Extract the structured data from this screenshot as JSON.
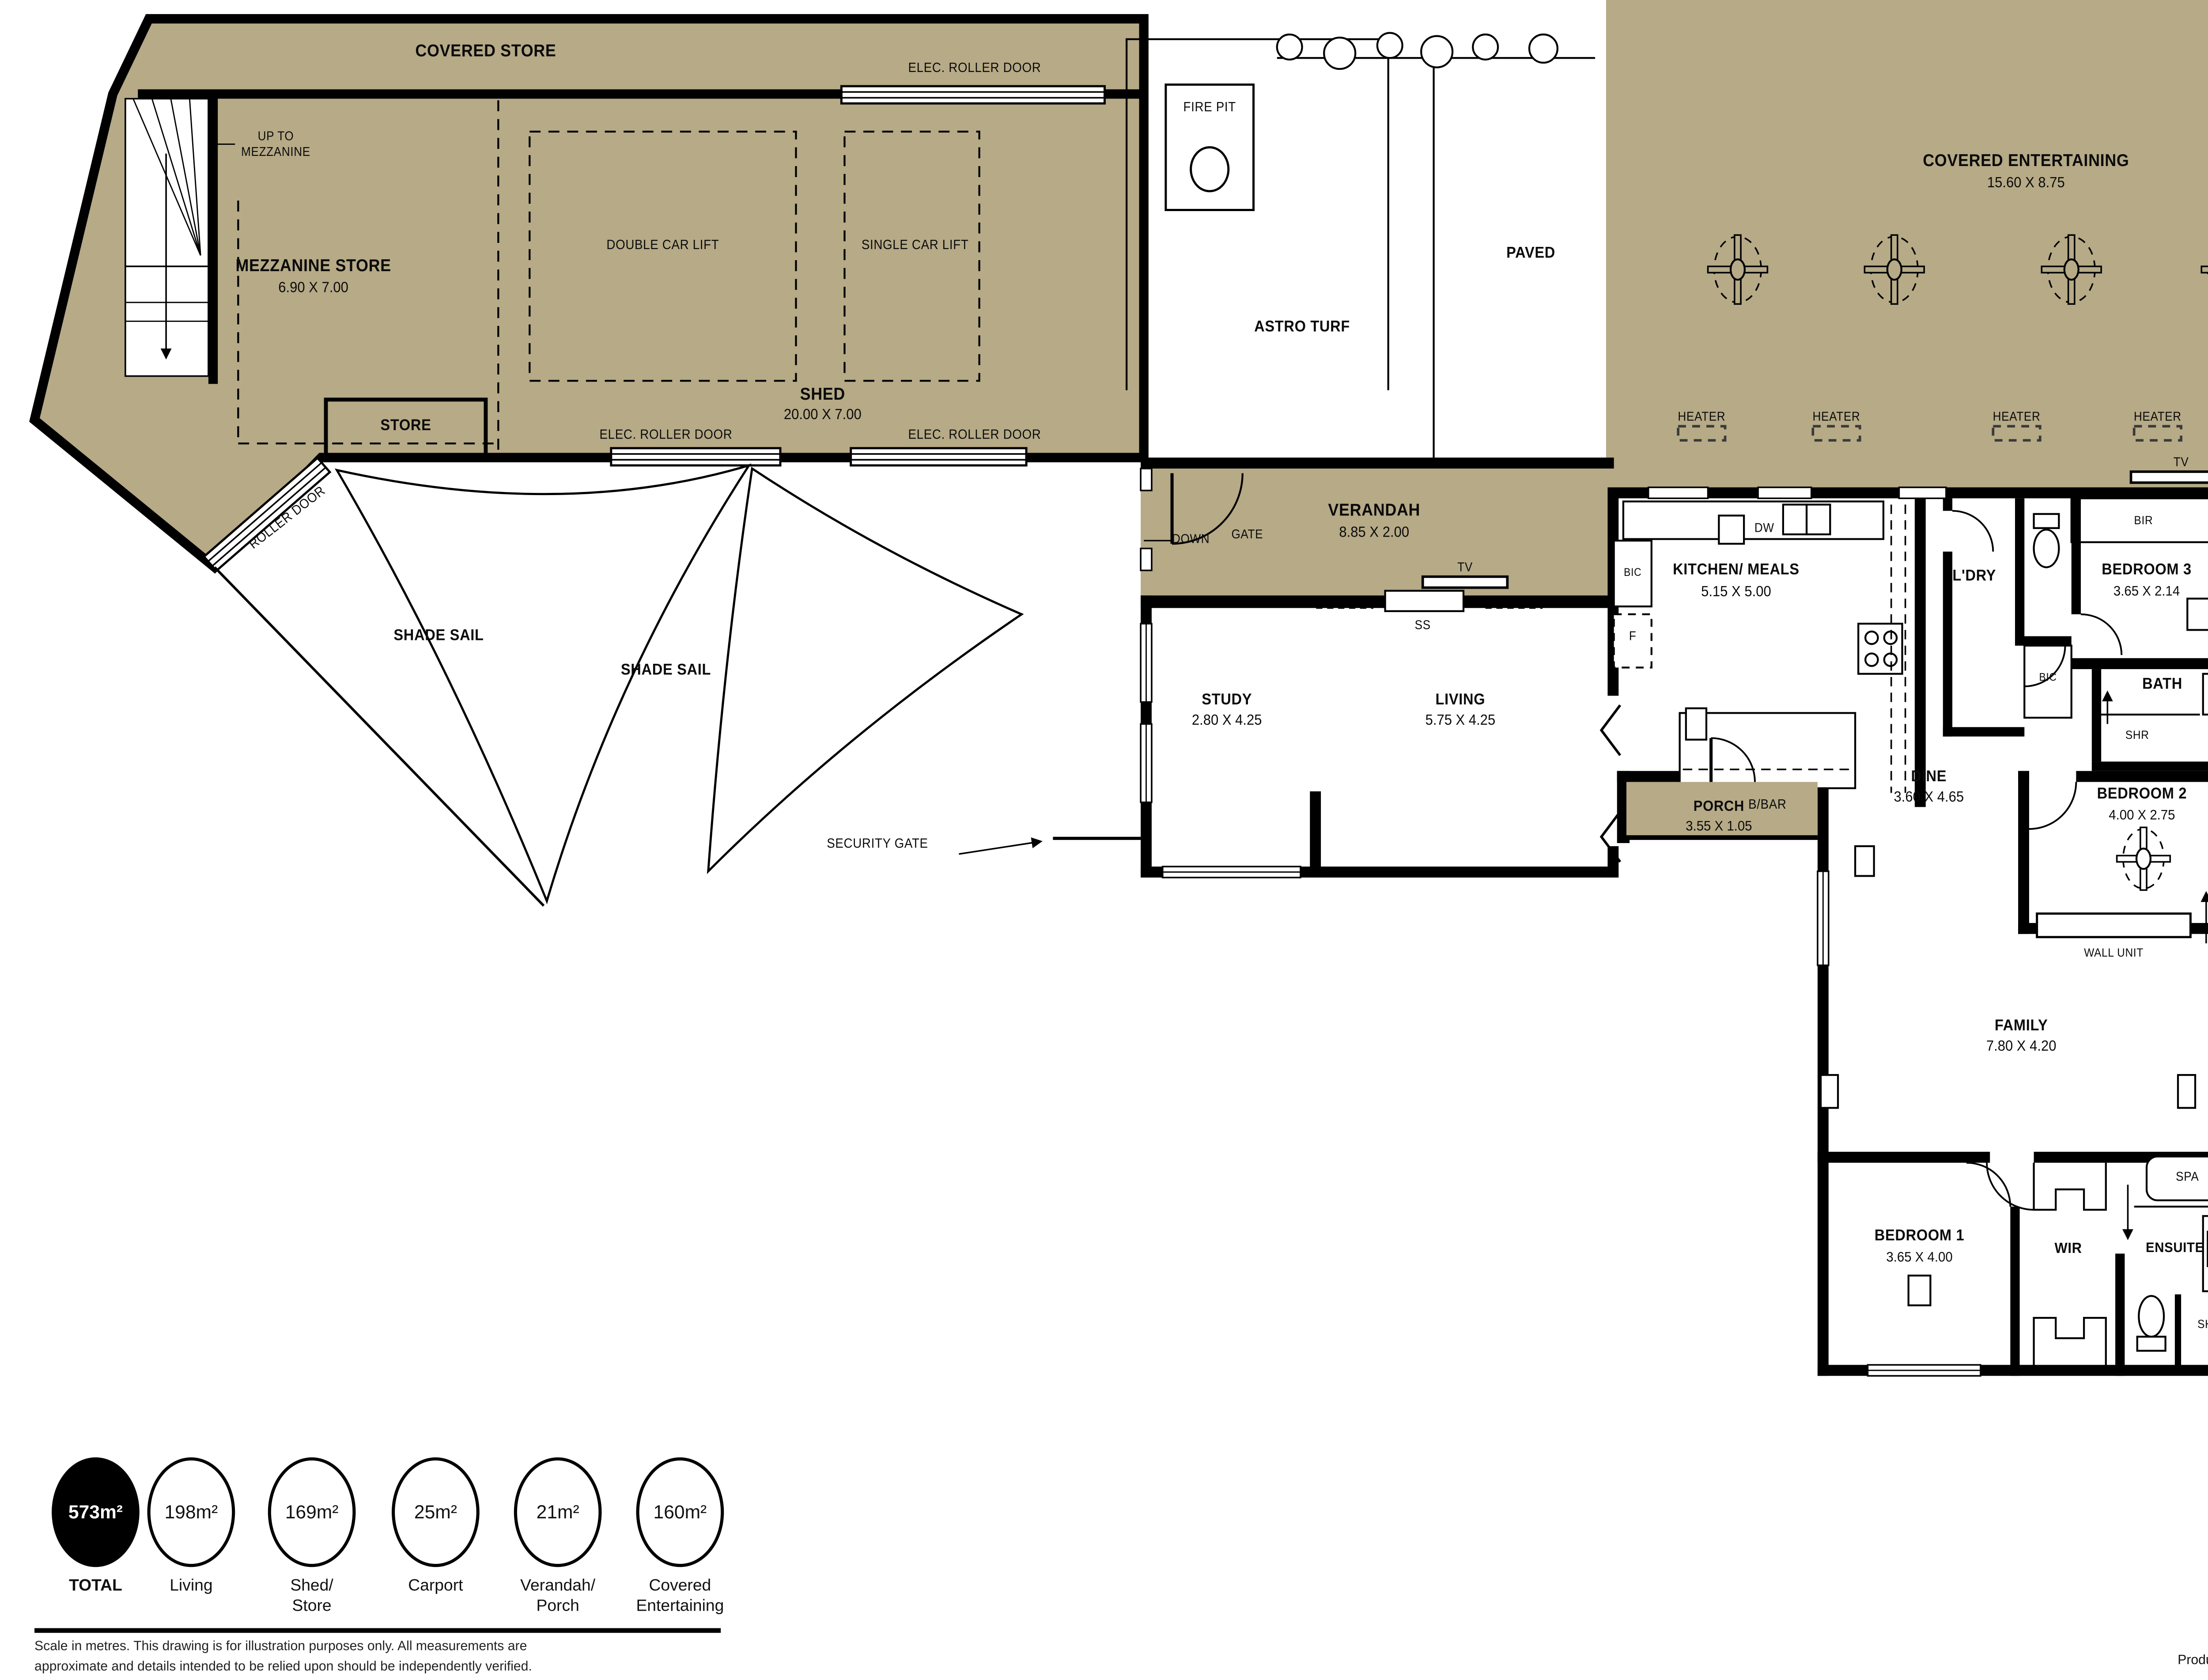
{
  "colors": {
    "covered_area": "#b6aa87",
    "wall": "#000000",
    "background": "#ffffff"
  },
  "labels": {
    "covered_store": "COVERED STORE",
    "elec_roller_door": "ELEC. ROLLER DOOR",
    "up_to_line1": "UP TO",
    "up_to_line2": "MEZZANINE",
    "mezzanine_store": "MEZZANINE STORE",
    "mezzanine_store_dims": "6.90 X 7.00",
    "double_car_lift": "DOUBLE CAR LIFT",
    "single_car_lift": "SINGLE CAR LIFT",
    "shed": "SHED",
    "shed_dims": "20.00 X 7.00",
    "store": "STORE",
    "roller_door": "ROLLER DOOR",
    "shade_sail": "SHADE SAIL",
    "security_gate": "SECURITY GATE",
    "fire_pit": "FIRE PIT",
    "astro_turf": "ASTRO TURF",
    "paved": "PAVED",
    "covered_entertaining": "COVERED ENTERTAINING",
    "covered_entertaining_dims": "15.60 X 8.75",
    "covered_ent2_line1": "COVERED",
    "covered_ent2_line2": "ENTERTAINING",
    "covered_ent2_dims": "2.75 X 10.00",
    "heater": "HEATER",
    "tv": "TV",
    "verandah": "VERANDAH",
    "verandah_dims": "8.85 X 2.00",
    "down": "DOWN",
    "gate": "GATE",
    "ss": "SS",
    "bic": "BIC",
    "f": "F",
    "dw": "DW",
    "kitchen_meals": "KITCHEN/ MEALS",
    "kitchen_meals_dims": "5.15 X 5.00",
    "bbar": "B/BAR",
    "ldry": "L'DRY",
    "bir": "BIR",
    "bedroom3": "BEDROOM 3",
    "bedroom3_dims": "3.65 X 2.14",
    "bath": "BATH",
    "shr": "SHR",
    "bbq": "BBQ",
    "bar": "BAR",
    "study": "STUDY",
    "study_dims": "2.80 X 4.25",
    "living": "LIVING",
    "living_dims": "5.75 X 4.25",
    "porch": "PORCH",
    "porch_dims": "3.55 X 1.05",
    "dine": "DINE",
    "dine_dims": "3.60 X 4.65",
    "bedroom2": "BEDROOM 2",
    "bedroom2_dims": "4.00 X 2.75",
    "wall_unit": "WALL UNIT",
    "family": "FAMILY",
    "family_dims": "7.80 X 4.20",
    "bedroom1": "BEDROOM 1",
    "bedroom1_dims": "3.65 X 4.00",
    "wir": "WIR",
    "ensuite": "ENSUITE",
    "spa": "SPA",
    "carport": "CARPORT",
    "carport_dims": "3.25 X 7.60"
  },
  "legend": {
    "items": [
      {
        "value": "573m²",
        "label1": "TOTAL",
        "label2": "",
        "filled": true
      },
      {
        "value": "198m²",
        "label1": "Living",
        "label2": ""
      },
      {
        "value": "169m²",
        "label1": "Shed/",
        "label2": "Store"
      },
      {
        "value": "25m²",
        "label1": "Carport",
        "label2": ""
      },
      {
        "value": "21m²",
        "label1": "Verandah/",
        "label2": "Porch"
      },
      {
        "value": "160m²",
        "label1": "Covered",
        "label2": "Entertaining"
      }
    ]
  },
  "footer": {
    "disclaimer_line1": "Scale in metres. This drawing is for illustration purposes only. All measurements are",
    "disclaimer_line2": "approximate and details intended to be relied upon should be independently verified.",
    "produced_prefix": "Produced by ",
    "produced_brand": "The Fotobase Group"
  }
}
